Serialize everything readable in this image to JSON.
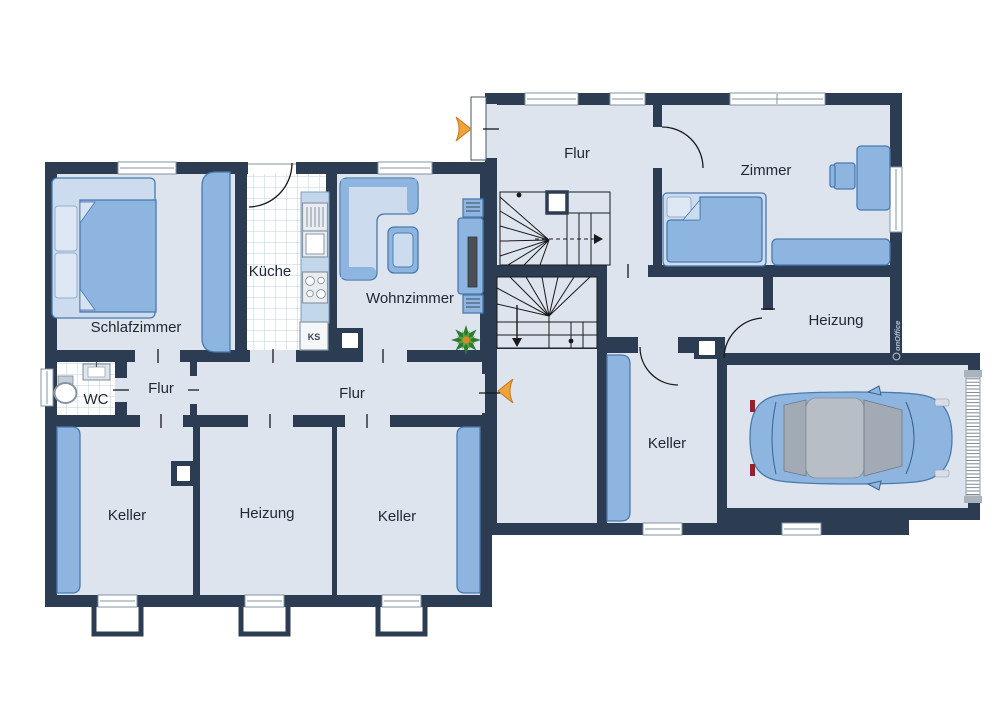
{
  "plan": {
    "type": "floorplan",
    "watermark": "onOffice",
    "colors": {
      "wall": "#2c3c52",
      "floor": "#dde4ee",
      "tile": "#bdd2e3",
      "furn": "#8db5e0",
      "furnstroke": "#4a7aae",
      "furnlight": "#ccdcee",
      "winframe": "#8494a3",
      "accent": "#f0a23b",
      "accentstroke": "#bf7a1d",
      "stair": "#1a1a1a",
      "label": "#1f2733",
      "wmcolor": "#b6c2d2"
    },
    "sections": {
      "basement": {
        "rooms": [
          {
            "id": "schlafzimmer",
            "label": "Schlafzimmer"
          },
          {
            "id": "kueche",
            "label": "Küche"
          },
          {
            "id": "wohnzimmer",
            "label": "Wohnzimmer"
          },
          {
            "id": "wc",
            "label": "WC"
          },
          {
            "id": "flur-klein",
            "label": "Flur"
          },
          {
            "id": "flur-gross",
            "label": "Flur"
          },
          {
            "id": "keller-west",
            "label": "Keller"
          },
          {
            "id": "heizung",
            "label": "Heizung"
          },
          {
            "id": "keller-ost",
            "label": "Keller"
          }
        ],
        "fridge_label": "KS"
      },
      "ground_floor": {
        "rooms": [
          {
            "id": "flur",
            "label": "Flur"
          },
          {
            "id": "zimmer",
            "label": "Zimmer"
          },
          {
            "id": "heizung",
            "label": "Heizung"
          },
          {
            "id": "keller",
            "label": "Keller"
          }
        ]
      }
    },
    "symbols": [
      "double-bed",
      "wardrobe",
      "kitchen-counter",
      "sink",
      "stove",
      "fridge",
      "corner-sofa",
      "coffee-table",
      "tv-board",
      "plant",
      "toilet",
      "washbasin",
      "staircase-up",
      "staircase-down",
      "entrance-arrow",
      "single-bed",
      "desk",
      "chair",
      "sideboard",
      "storage-shelf",
      "car",
      "garage-door",
      "window",
      "light-well"
    ]
  }
}
